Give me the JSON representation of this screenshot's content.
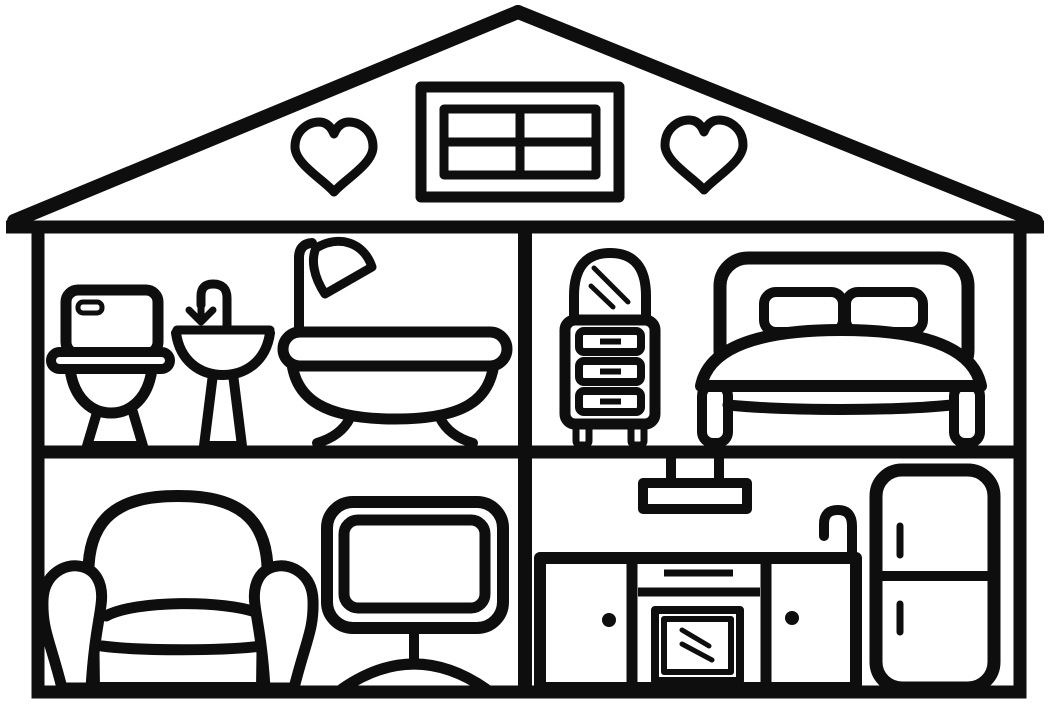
{
  "scene": {
    "description": "Black-and-white dollhouse cutaway coloring page: a two-story house cross-section with furnished rooms",
    "style": "thick black line art on white, no text",
    "line_color": "#0e0e0e",
    "background_color": "#ffffff"
  },
  "attic": {
    "items": [
      "heart-icon-left",
      "four-pane-attic-window",
      "heart-icon-right"
    ]
  },
  "rooms": [
    {
      "name": "bathroom",
      "position": "upper-left",
      "furniture": [
        "toilet",
        "pedestal-sink-with-faucet",
        "clawfoot-bathtub-with-shower"
      ]
    },
    {
      "name": "bedroom",
      "position": "upper-right",
      "furniture": [
        "dresser-with-arched-mirror",
        "double-bed-with-two-pillows"
      ]
    },
    {
      "name": "living-room",
      "position": "lower-left",
      "furniture": [
        "armchair",
        "television-on-stand"
      ]
    },
    {
      "name": "kitchen",
      "position": "lower-right",
      "furniture": [
        "cooker-hood",
        "kitchen-counter-with-oven-and-two-doors",
        "sink-faucet",
        "two-door-refrigerator"
      ]
    }
  ]
}
